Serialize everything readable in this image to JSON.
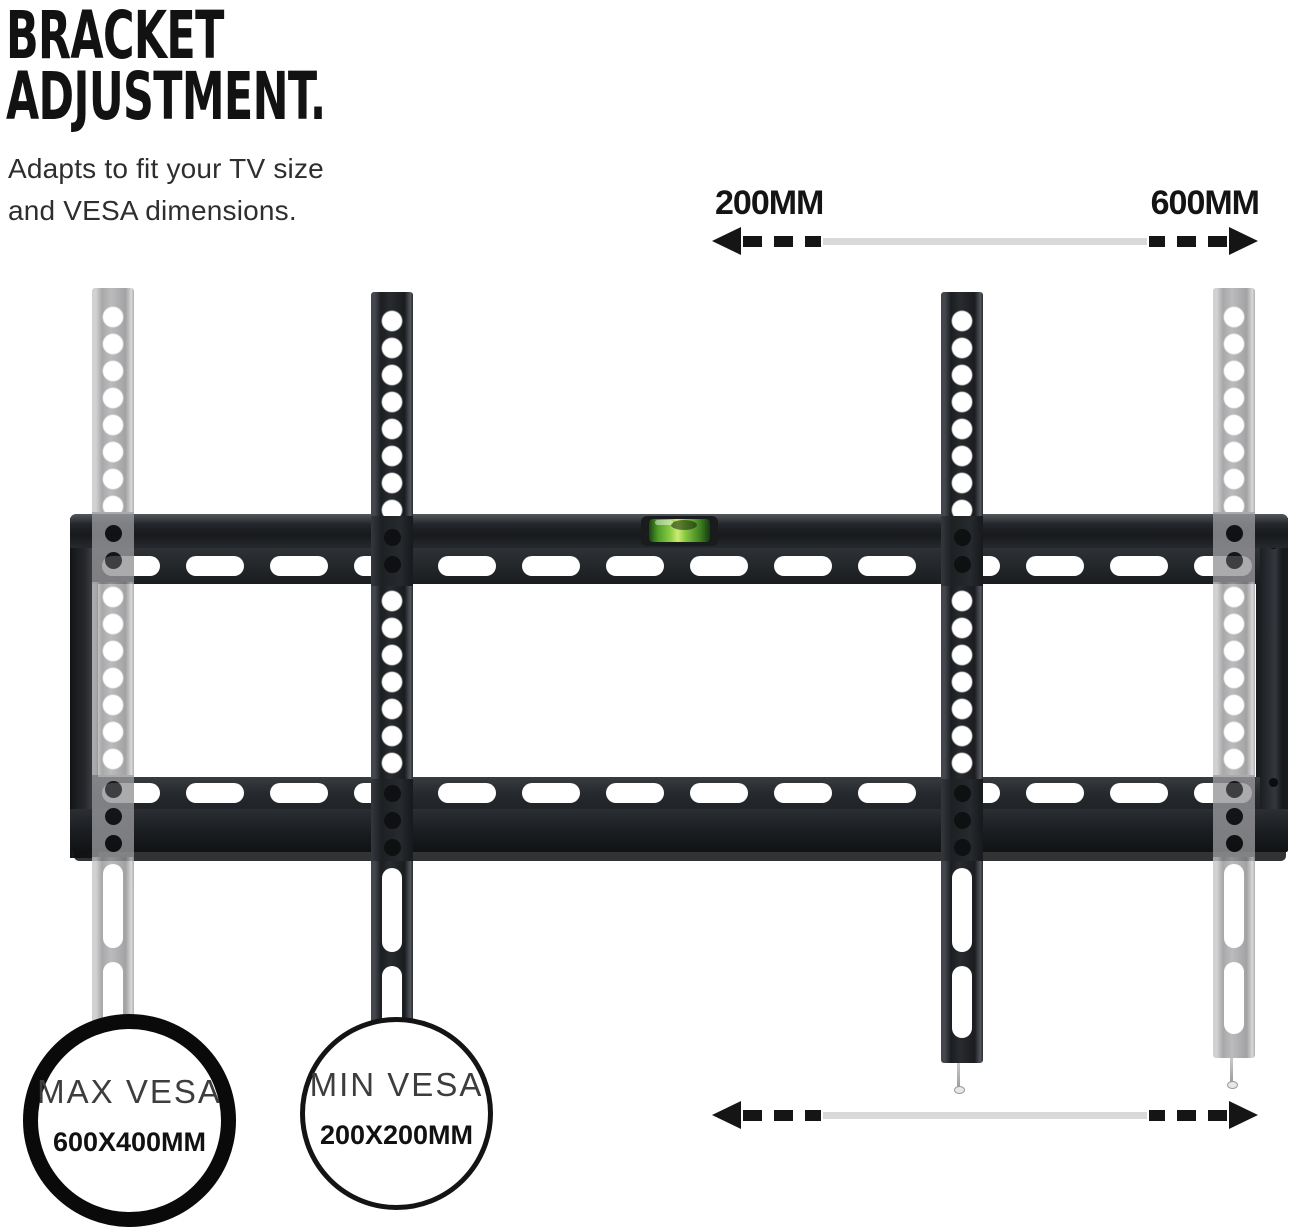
{
  "header": {
    "title_line1": "BRACKET",
    "title_line2": "ADJUSTMENT.",
    "subtitle_line1": "Adapts to fit your TV size",
    "subtitle_line2": "and VESA dimensions."
  },
  "dimensions": {
    "top_min_label": "200MM",
    "top_max_label": "600MM"
  },
  "badges": {
    "max_vesa": {
      "label": "MAX VESA",
      "value": "600X400MM"
    },
    "min_vesa": {
      "label": "MIN VESA",
      "value": "200X200MM"
    }
  },
  "colors": {
    "metal_black": "#1d2023",
    "metal_ghost_gray": "#a0a0a2",
    "arrow_black": "#151515",
    "arrow_track_gray": "#d9d9d9",
    "level_green": "#8bcc44",
    "text_dark": "#141414",
    "background": "#ffffff"
  },
  "icons": {
    "spirit_level": "spirit-level-icon",
    "arrowhead_left": "arrowhead-left-icon",
    "arrowhead_right": "arrowhead-right-icon"
  }
}
